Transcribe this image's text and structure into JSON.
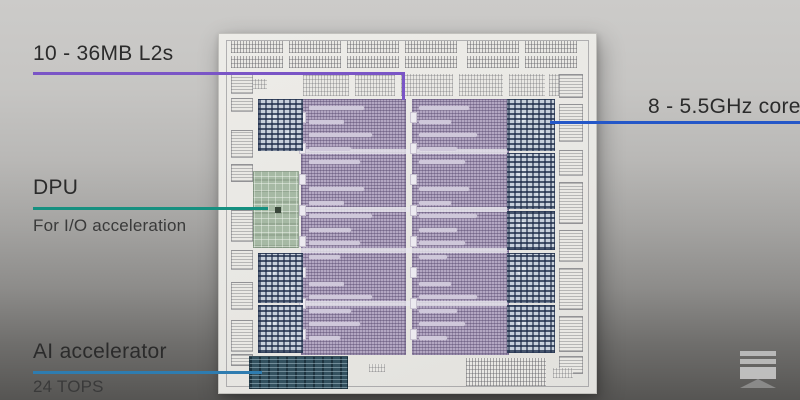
{
  "frame": {
    "bg_top": "#cccbc9",
    "bg_bottom": "#565553"
  },
  "annotations": {
    "l2": {
      "label": "10 - 36MB L2s",
      "line_color": "#7a55c6"
    },
    "cores": {
      "label": "8 - 5.5GHz cores",
      "line_color": "#2457c8"
    },
    "dpu": {
      "label": "DPU",
      "subtitle": "For I/O acceleration",
      "line_color": "#169080"
    },
    "ai": {
      "label": "AI accelerator",
      "subtitle": "24 TOPS",
      "line_color": "#2e7cb0"
    }
  },
  "die": {
    "bg": "#eae9e5",
    "l2_color": "#b3a7c2",
    "core_base": "#c7d0db",
    "core_dark": "#31435f",
    "dpu_color": "#a6b9a4",
    "ai_color": "#33515f",
    "pattern_gray": "#8f8f93"
  },
  "watermark": {
    "name": "sth-logo",
    "color": "#c2c2c2",
    "chevron_color": "#8e8e8e"
  }
}
